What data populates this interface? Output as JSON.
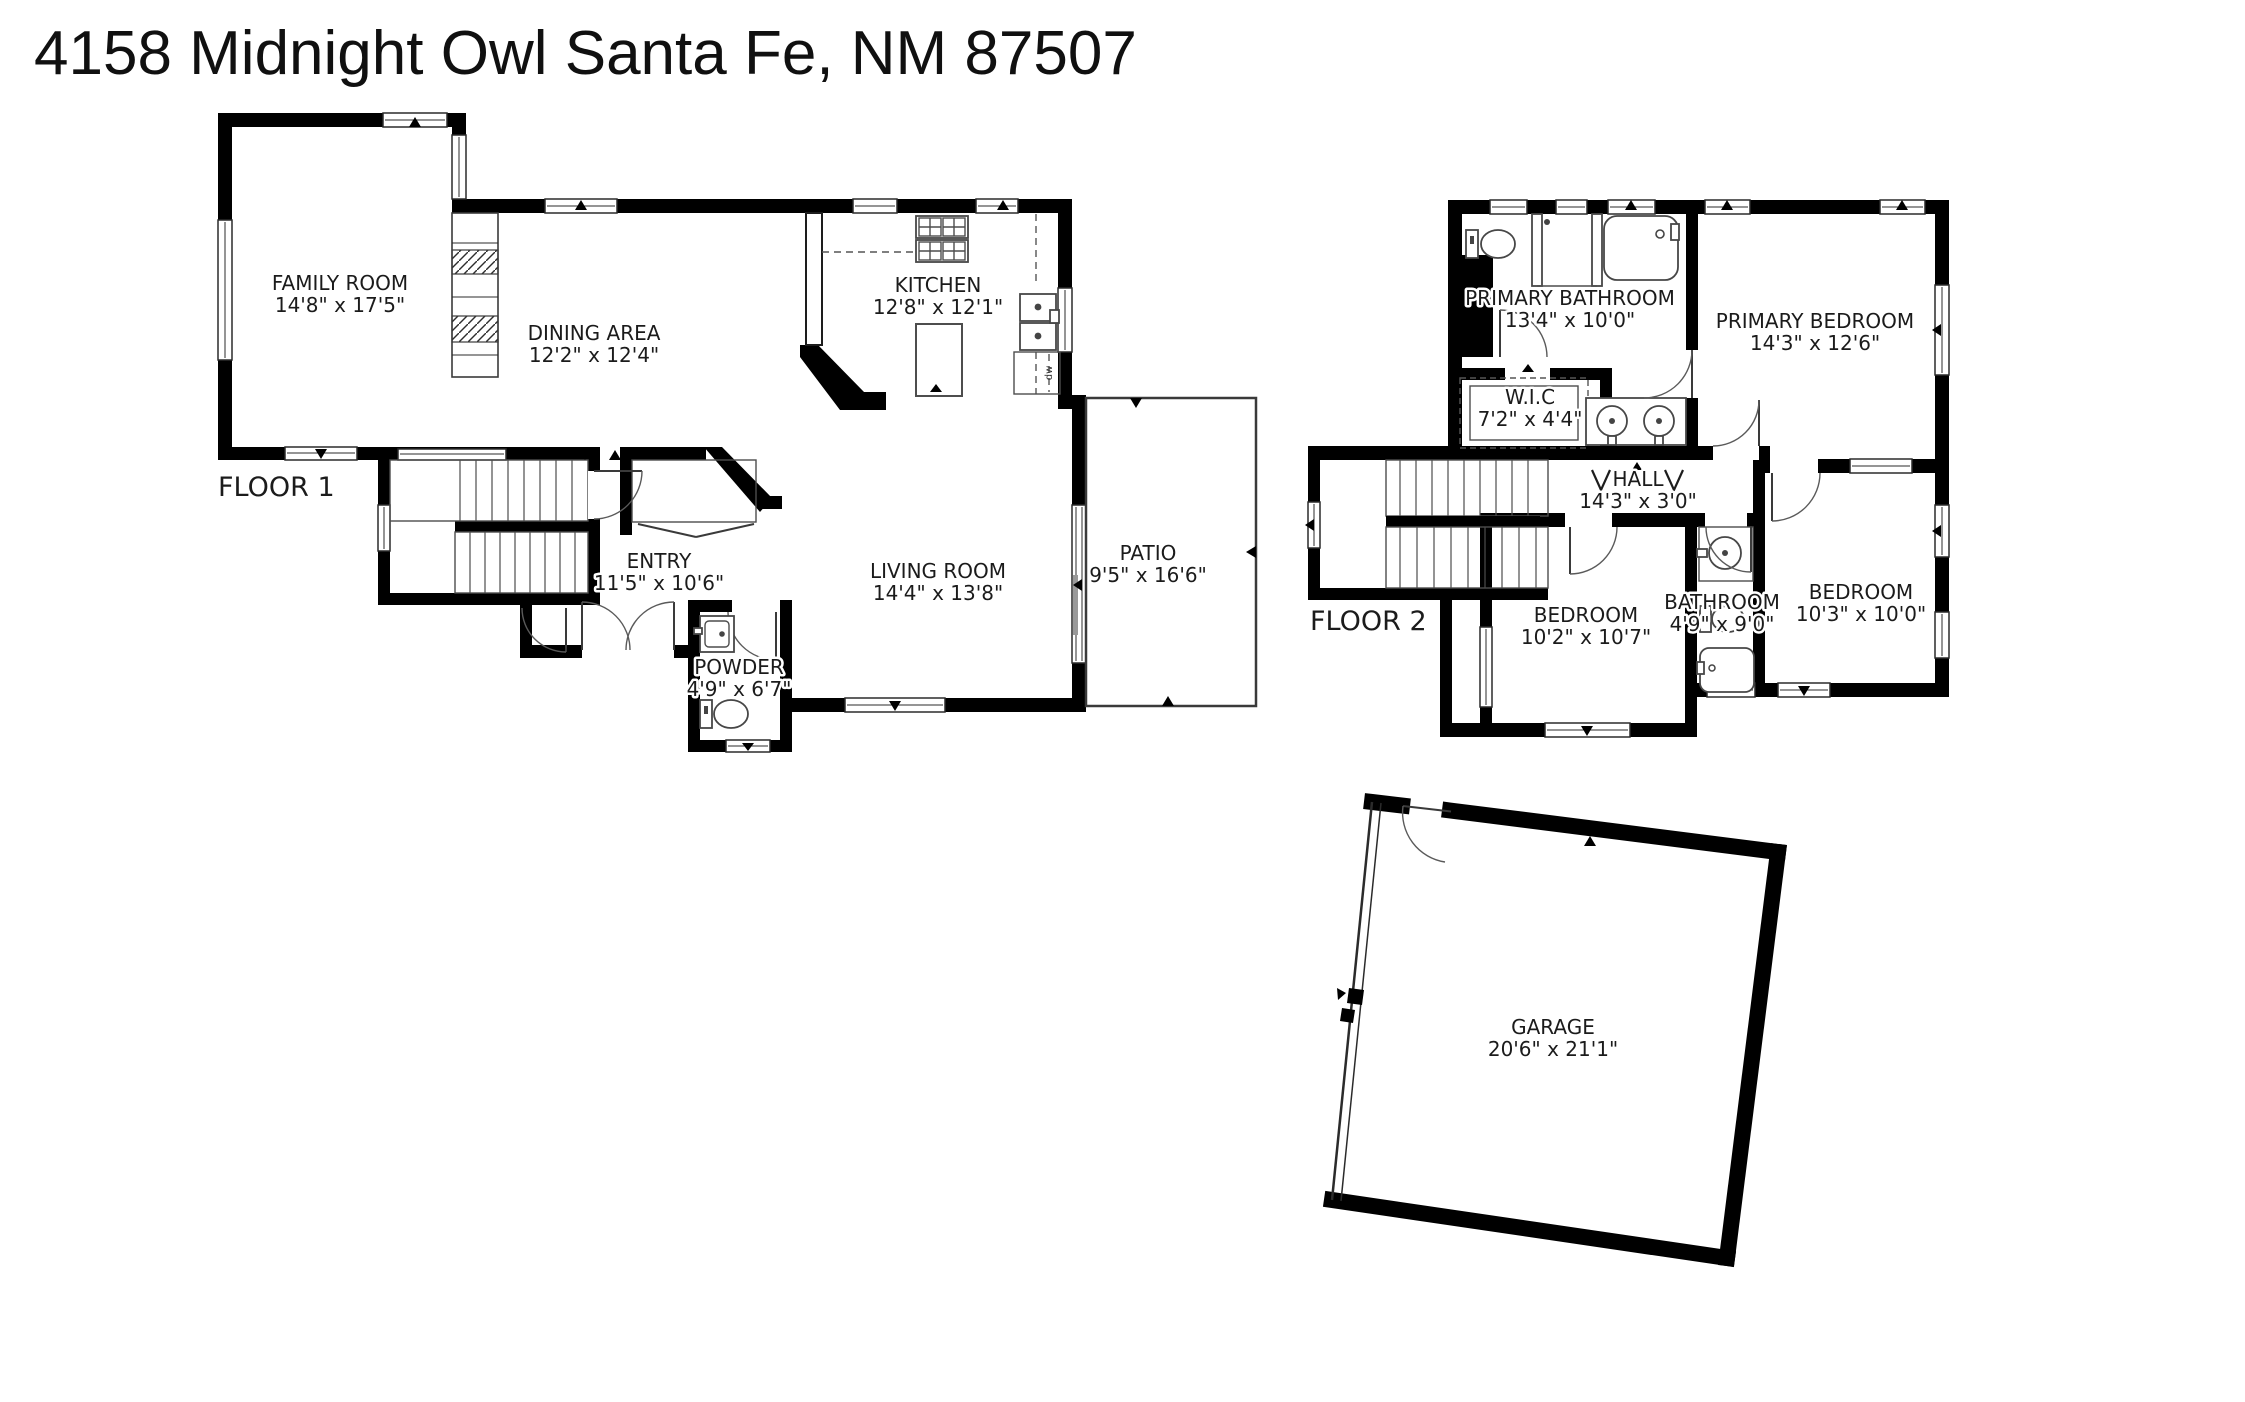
{
  "title": "4158 Midnight Owl Santa Fe, NM 87507",
  "colors": {
    "wall": "#000000",
    "background": "#ffffff",
    "text": "#1b1b1b",
    "line": "#4d4d4d"
  },
  "floor1": {
    "label": "FLOOR 1",
    "rooms": {
      "family_room": {
        "name": "FAMILY ROOM",
        "dims": "14'8\" x 17'5\""
      },
      "dining_area": {
        "name": "DINING AREA",
        "dims": "12'2\" x 12'4\""
      },
      "kitchen": {
        "name": "KITCHEN",
        "dims": "12'8\" x 12'1\"",
        "dishwasher_label": "dw"
      },
      "entry": {
        "name": "ENTRY",
        "dims": "11'5\" x 10'6\""
      },
      "living_room": {
        "name": "LIVING ROOM",
        "dims": "14'4\" x 13'8\""
      },
      "powder": {
        "name": "POWDER",
        "dims": "4'9\" x 6'7\""
      },
      "patio": {
        "name": "PATIO",
        "dims": "9'5\" x 16'6\""
      }
    }
  },
  "floor2": {
    "label": "FLOOR 2",
    "rooms": {
      "primary_bathroom": {
        "name": "PRIMARY BATHROOM",
        "dims": "13'4\" x 10'0\""
      },
      "wic": {
        "name": "W.I.C",
        "dims": "7'2\" x 4'4\""
      },
      "primary_bedroom": {
        "name": "PRIMARY BEDROOM",
        "dims": "14'3\" x 12'6\""
      },
      "hall": {
        "name": "HALL",
        "dims": "14'3\" x 3'0\""
      },
      "bedroom_left": {
        "name": "BEDROOM",
        "dims": "10'2\" x 10'7\""
      },
      "bathroom": {
        "name": "BATHROOM",
        "dims": "4'9\" x 9'0\""
      },
      "bedroom_right": {
        "name": "BEDROOM",
        "dims": "10'3\" x 10'0\""
      }
    }
  },
  "garage": {
    "name": "GARAGE",
    "dims": "20'6\" x 21'1\""
  }
}
